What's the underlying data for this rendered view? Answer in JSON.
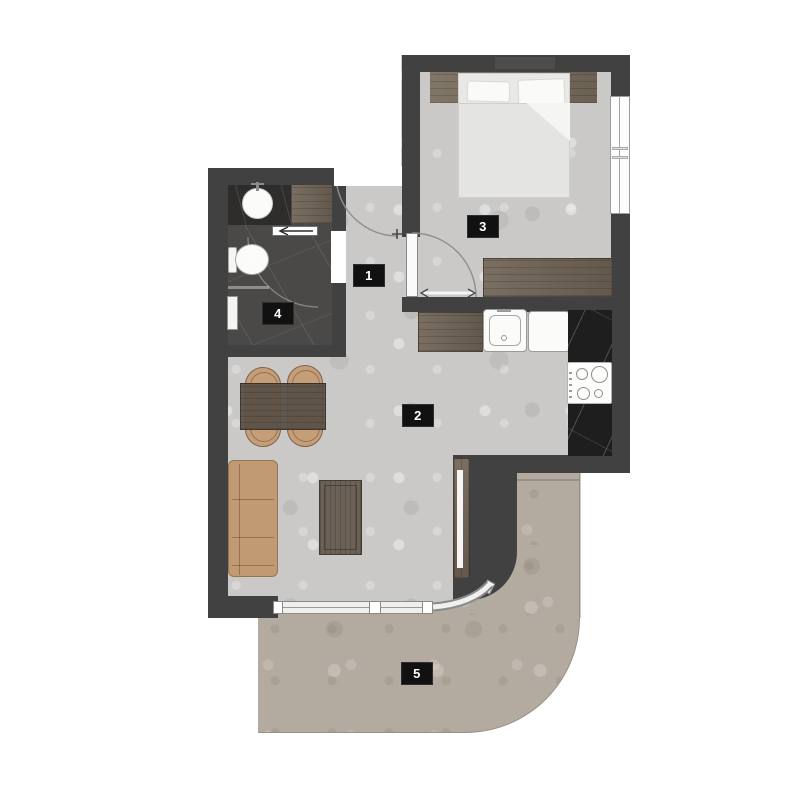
{
  "rooms": [
    {
      "number": "1"
    },
    {
      "number": "2"
    },
    {
      "number": "3"
    },
    {
      "number": "4"
    },
    {
      "number": "5"
    }
  ],
  "colors": {
    "wall": "#414141",
    "floor_concrete": "#cac9c7",
    "floor_terrace": "#b3aaa0",
    "kitchen_marble": "#1e1e1e",
    "bathroom_marble": "#4b4947",
    "shower_marble": "#2e2d2c",
    "wood": "#6f6355",
    "upholstery_tan": "#c59e78",
    "bed_linen": "#e9e8e6",
    "label_background": "#111111",
    "label_text": "#ffffff"
  }
}
